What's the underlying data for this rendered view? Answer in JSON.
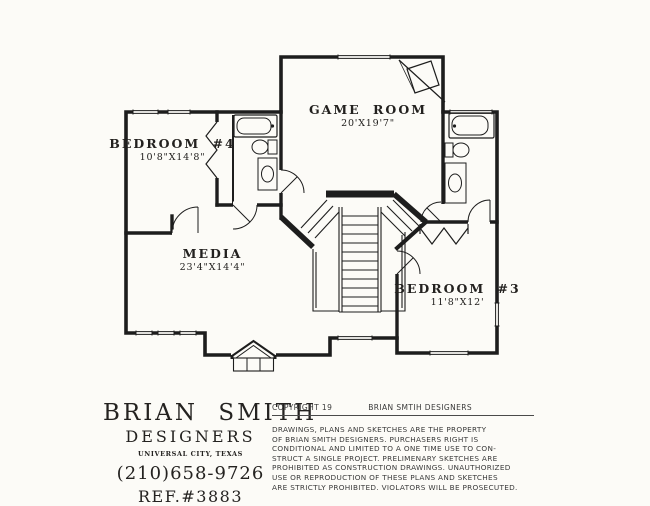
{
  "palette": {
    "paper": "#fcfbf7",
    "ink": "#1d1d1d"
  },
  "plan": {
    "rooms": [
      {
        "id": "game-room",
        "name": "GAME ROOM",
        "dims": "20'X19'7\""
      },
      {
        "id": "bedroom-4",
        "name": "BEDROOM #4",
        "dims": "10'8\"X14'8\""
      },
      {
        "id": "media",
        "name": "MEDIA",
        "dims": "23'4\"X14'4\""
      },
      {
        "id": "bedroom-3",
        "name": "BEDROOM #3",
        "dims": "11'8\"X12'"
      }
    ]
  },
  "title_block": {
    "firm_name": "BRIAN SMITH",
    "firm_subtitle": "DESIGNERS",
    "location": "UNIVERSAL CITY, TEXAS",
    "phone": "(210)658-9726",
    "reference": "REF.#3883"
  },
  "copyright_block": {
    "copyright_label": "COPYRIGHT 19",
    "firm": "BRIAN SMTIH DESIGNERS",
    "body_lines": [
      "DRAWINGS, PLANS AND SKETCHES ARE THE PROPERTY",
      "OF BRIAN SMITH DESIGNERS.  PURCHASERS RIGHT IS",
      "CONDITIONAL AND LIMITED TO A ONE TIME USE TO CON-",
      "STRUCT A SINGLE PROJECT.  PRELIMENARY SKETCHES ARE",
      "PROHIBITED AS CONSTRUCTION DRAWINGS.  UNAUTHORIZED",
      "USE OR REPRODUCTION OF THESE PLANS AND SKETCHES",
      "ARE STRICTLY PROHIBITED.  VIOLATORS WILL BE PROSECUTED."
    ]
  }
}
